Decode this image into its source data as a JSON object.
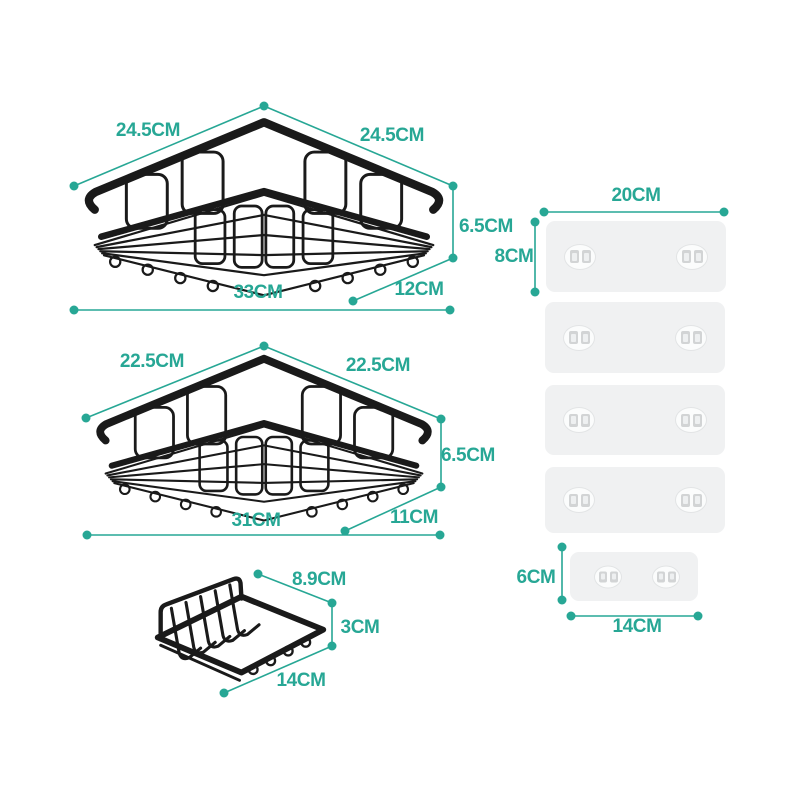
{
  "colors": {
    "accent": "#27a795",
    "wire_black": "#1a1a1a",
    "plate_fill": "#f0f1f2"
  },
  "products": {
    "basket_large": {
      "side_left": "24.5CM",
      "side_right": "24.5CM",
      "height": "6.5CM",
      "width": "33CM",
      "depth": "12CM"
    },
    "basket_medium": {
      "side_left": "22.5CM",
      "side_right": "22.5CM",
      "height": "6.5CM",
      "width": "31CM",
      "depth": "11CM"
    },
    "soap_dish": {
      "depth": "8.9CM",
      "height": "3CM",
      "width": "14CM"
    },
    "adhesive_plate_large": {
      "width": "20CM",
      "height": "8CM",
      "count": 4
    },
    "adhesive_plate_small": {
      "width": "14CM",
      "height": "6CM",
      "count": 1
    }
  }
}
